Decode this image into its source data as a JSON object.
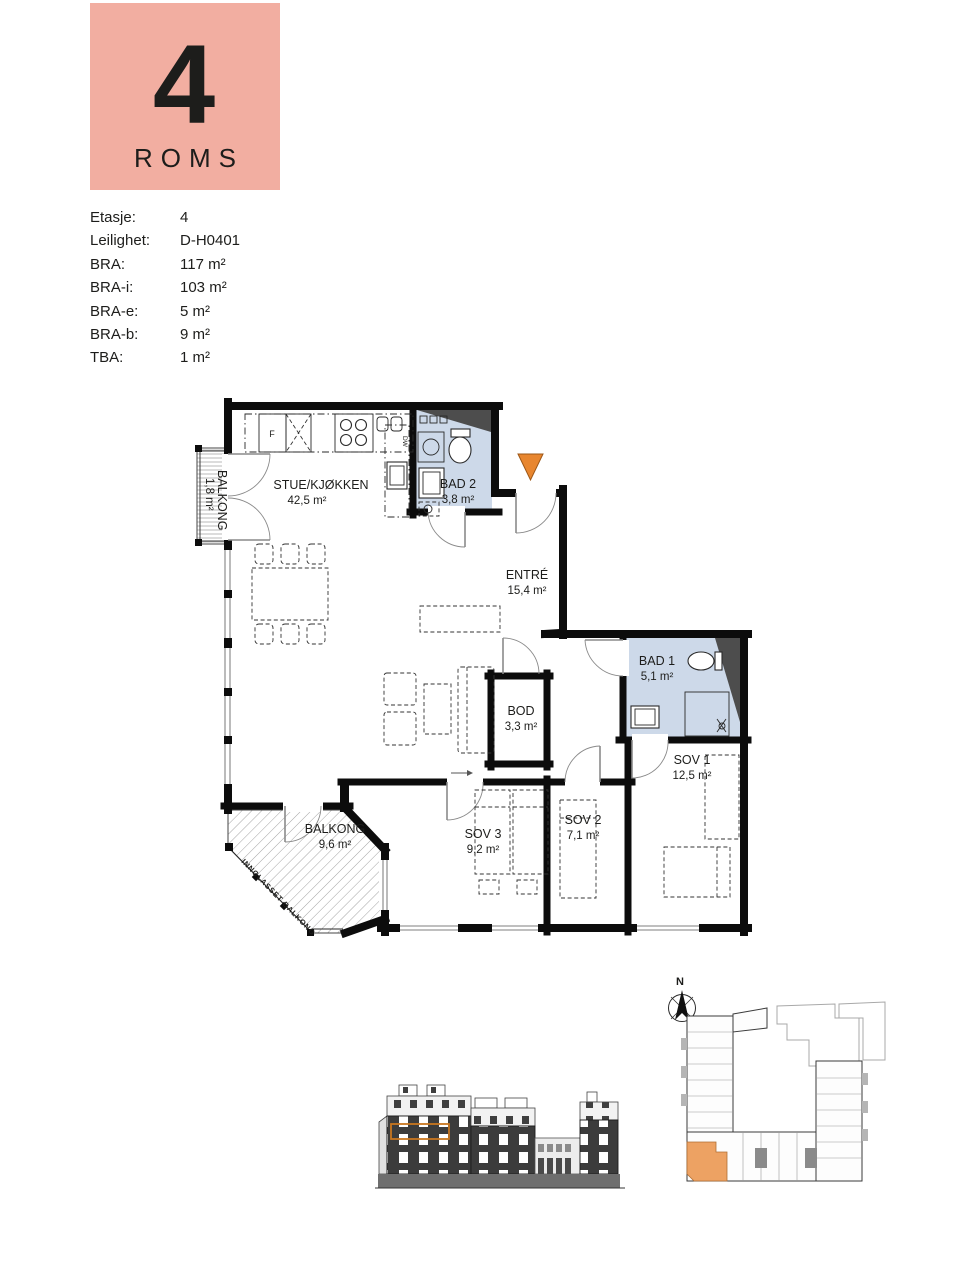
{
  "badge": {
    "number": "4",
    "label": "ROMS"
  },
  "specs": {
    "rows": [
      {
        "label": "Etasje:",
        "value": "4"
      },
      {
        "label": "Leilighet:",
        "value": "D-H0401"
      },
      {
        "label": "BRA:",
        "value": "117 m²"
      },
      {
        "label": "BRA-i:",
        "value": "103 m²"
      },
      {
        "label": "BRA-e:",
        "value": "5 m²"
      },
      {
        "label": "BRA-b:",
        "value": "9 m²"
      },
      {
        "label": "TBA:",
        "value": "1 m²"
      }
    ]
  },
  "floor_plan": {
    "rooms": [
      {
        "name": "STUE/KJØKKEN",
        "area": "42,5 m²"
      },
      {
        "name": "BAD 2",
        "area": "3,8 m²"
      },
      {
        "name": "ENTRÉ",
        "area": "15,4 m²"
      },
      {
        "name": "BAD 1",
        "area": "5,1 m²"
      },
      {
        "name": "BOD",
        "area": "3,3 m²"
      },
      {
        "name": "SOV 1",
        "area": "12,5 m²"
      },
      {
        "name": "SOV 2",
        "area": "7,1 m²"
      },
      {
        "name": "SOV 3",
        "area": "9,2 m²"
      },
      {
        "name": "BALKONG",
        "area": "9,6 m²"
      },
      {
        "name": "BALKONG",
        "area": "1,8 m²"
      }
    ],
    "labels": {
      "glazed_balcony": "INNGLASSET BALKONG",
      "fridge": "F",
      "dishwasher": "DW"
    }
  },
  "site_plan": {
    "north_label": "N"
  },
  "colors": {
    "badge_bg": "#F2AEA1",
    "bathroom_fill": "#CDD9E9",
    "entrance_marker": "#E8862F",
    "duct_gray": "#4d4d4d",
    "site_highlight": "#EDA263",
    "elevation_highlight": "#C8761F"
  }
}
